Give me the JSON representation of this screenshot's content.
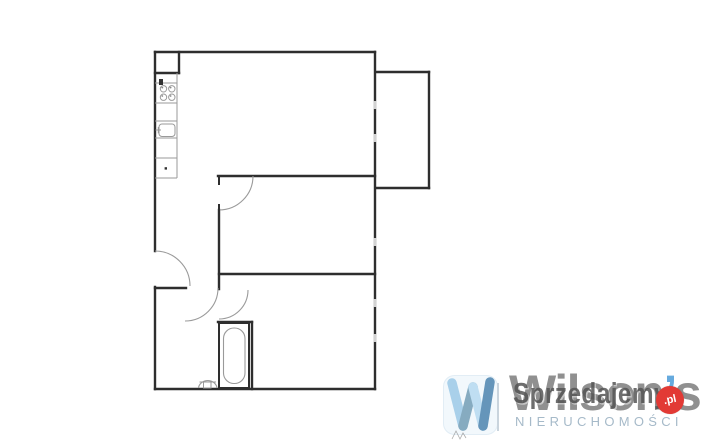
{
  "floorplan": {
    "wall_color": "#2e2e2e",
    "thin_color": "#9a9a9a",
    "window_mark_color": "#d2d2d2",
    "walls": [
      [
        155,
        52,
        375,
        52
      ],
      [
        155,
        52,
        155,
        251
      ],
      [
        155,
        287,
        155,
        389
      ],
      [
        155,
        389,
        375,
        389
      ],
      [
        375,
        52,
        375,
        389
      ],
      [
        179,
        52,
        179,
        73
      ],
      [
        155,
        73,
        179,
        73
      ],
      [
        218,
        176,
        375,
        176
      ],
      [
        219,
        210,
        219,
        289
      ],
      [
        219,
        274,
        375,
        274
      ],
      [
        155,
        288,
        186,
        288
      ],
      [
        218,
        322,
        252,
        322
      ],
      [
        252,
        322,
        252,
        389
      ],
      [
        376,
        72,
        429,
        72
      ],
      [
        429,
        72,
        429,
        188
      ],
      [
        376,
        188,
        429,
        188
      ]
    ],
    "window_marks": [
      [
        375,
        101,
        375,
        109
      ],
      [
        375,
        134,
        375,
        142
      ],
      [
        375,
        238,
        375,
        246
      ],
      [
        375,
        299,
        375,
        307
      ],
      [
        375,
        334,
        375,
        342
      ]
    ],
    "door_arcs": [
      {
        "name": "entrance-door",
        "x1": 155,
        "y1": 251,
        "r": 35,
        "x2": 190,
        "y2": 286
      },
      {
        "name": "middle-room-door",
        "x1": 253,
        "y1": 176,
        "r": 34,
        "x2": 219,
        "y2": 210
      },
      {
        "name": "bathroom-door",
        "x1": 218,
        "y1": 288,
        "r": 33,
        "x2": 185,
        "y2": 321
      },
      {
        "name": "rear-room-door",
        "x1": 248,
        "y1": 290,
        "r": 29,
        "x2": 219,
        "y2": 319
      }
    ],
    "door_jambs": [
      [
        219,
        176,
        219,
        184
      ],
      [
        219,
        205,
        219,
        211
      ]
    ],
    "kitchen": {
      "lines": [
        [
          177,
          73,
          177,
          178
        ],
        [
          155,
          83,
          177,
          83
        ],
        [
          155,
          103,
          177,
          103
        ],
        [
          155,
          121,
          177,
          121
        ],
        [
          155,
          138,
          177,
          138
        ],
        [
          155,
          158,
          177,
          158
        ],
        [
          155,
          178,
          177,
          178
        ]
      ],
      "burners": [
        [
          163.5,
          88.8
        ],
        [
          171.8,
          88.8
        ],
        [
          163.5,
          97.2
        ],
        [
          171.8,
          97.2
        ]
      ],
      "burner_radius": 3.2,
      "burner_dots": [
        [
          162.3,
          87.6
        ],
        [
          170.6,
          87.6
        ],
        [
          162.3,
          96
        ],
        [
          170.6,
          96
        ]
      ],
      "dark_marks": [
        [
          159,
          79,
          4,
          6
        ],
        [
          164.6,
          167.2,
          2.4,
          2.4
        ]
      ],
      "sink": {
        "x": 159,
        "y": 124,
        "w": 16,
        "h": 12.5,
        "rx": 3
      },
      "faucet_lines": [
        [
          155.5,
          130,
          161,
          130
        ],
        [
          158.3,
          127,
          158.3,
          133.3
        ]
      ]
    },
    "bathtub": {
      "outer": {
        "x": 219,
        "y": 323,
        "w": 30,
        "h": 65
      },
      "inner": {
        "x": 223.5,
        "y": 328,
        "w": 21.5,
        "h": 55.5,
        "rx": 10.5
      }
    },
    "toilet": {
      "bowl_path": "M198.5,388 A9.3,8.3 0 0 1 217,388",
      "base": {
        "x": 203.5,
        "y": 382,
        "w": 7.5,
        "h": 6
      },
      "shelf_line": [
        199.5,
        382,
        216,
        382
      ]
    }
  },
  "branding": {
    "wordmark": "Wilson",
    "wordmark_apostrophe": "’",
    "wordmark_s": "s",
    "subtitle": "NIERUCHOMOŚCI",
    "watermark_text": "Sprzedajemy",
    "badge_text": ".pl",
    "wordmark_color": "#909090",
    "apostrophe_color": "#66aade",
    "subtitle_color": "#a6bac9",
    "divider_color": "#c9d4dd",
    "watermark_color": "#555555",
    "badge_color": "#e23a35",
    "badge_text_color": "#ffffff",
    "tile": {
      "bg": "#f2f8fc",
      "edge": "#e2edf5",
      "strokes": [
        {
          "d": "M9,8 L20,51",
          "c": "#a9d0ea"
        },
        {
          "d": "M20,51 L30,12",
          "c": "#86abc0"
        },
        {
          "d": "M30,12 L40,51",
          "c": "#bfdef2"
        },
        {
          "d": "M40,51 L47,7",
          "c": "#6595ba"
        }
      ]
    },
    "signature_color": "#8a8a8a"
  }
}
